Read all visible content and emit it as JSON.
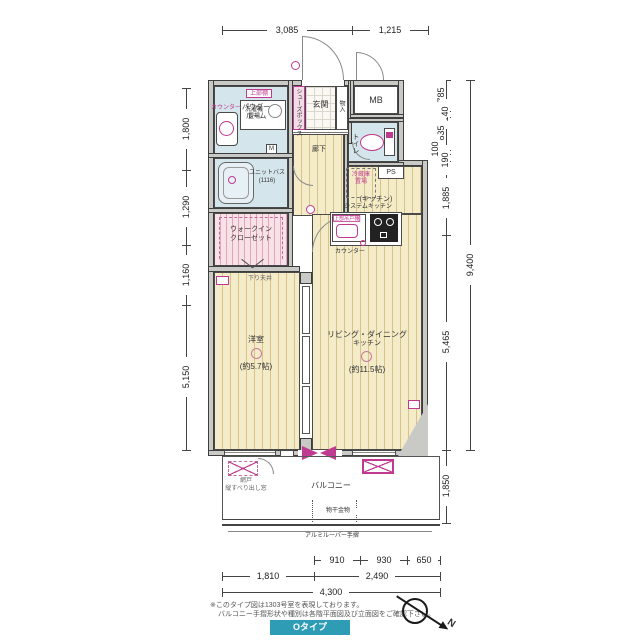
{
  "dimensions": {
    "top": [
      "3,085",
      "1,215"
    ],
    "left": [
      "1,800",
      "1,290",
      "1,160",
      "5,150"
    ],
    "right": [
      "785",
      "140",
      "835",
      "100",
      "190",
      "1,885",
      "5,465"
    ],
    "right_total": "9,400",
    "balcony_depth": "1,850",
    "bottom_row1": [
      "910",
      "930",
      "650"
    ],
    "bottom_row2": [
      "1,810",
      "2,490"
    ],
    "bottom_total": "4,300"
  },
  "rooms": {
    "entrance": "玄関",
    "powder_line1": "パウダー",
    "powder_line2": "ルーム",
    "toilet": "トイレ",
    "unit_bath": "ユニットバス",
    "unit_bath_size": "(1116)",
    "hallway": "廊下",
    "kitchen_zone": "(キッチン)",
    "wic_line1": "ウォークイン",
    "wic_line2": "クローゼット",
    "bedroom": "洋室",
    "bedroom_size": "(約5.7帖)",
    "ldk_line1": "リビング・ダイニング",
    "ldk_line2": "キッチン",
    "ldk_size": "(約11.5帖)",
    "balcony": "バルコニー"
  },
  "labels": {
    "mb": "MB",
    "ps": "PS",
    "shoes_box": "シューズボックス",
    "storage": "物入",
    "upper_shelf": "上部棚",
    "washer_line1": "洗濯機",
    "washer_line2": "置場",
    "powder_counter": "カウンター",
    "mirror": "M",
    "fridge_line1": "冷蔵庫",
    "fridge_line2": "置場",
    "system_kitchen": "システムキッチン",
    "hanging_cupboard": "上部吊戸棚",
    "kitchen_counter": "カウンター",
    "lowered_ceiling": "下り天井",
    "laundry_hardware": "物干金物",
    "louver_rail": "アルミルーバー手摺",
    "window_note_line1": "網戸",
    "window_note_line2": "縦すべり出し窓"
  },
  "notes": {
    "line1": "※このタイプ図は1303号室を表現しております。",
    "line2": "バルコニー手摺形状や種別は各階平面図及び立面図をご確認下さい。"
  },
  "footer": {
    "type_label": "Oタイプ"
  },
  "compass": {
    "north": "N"
  }
}
